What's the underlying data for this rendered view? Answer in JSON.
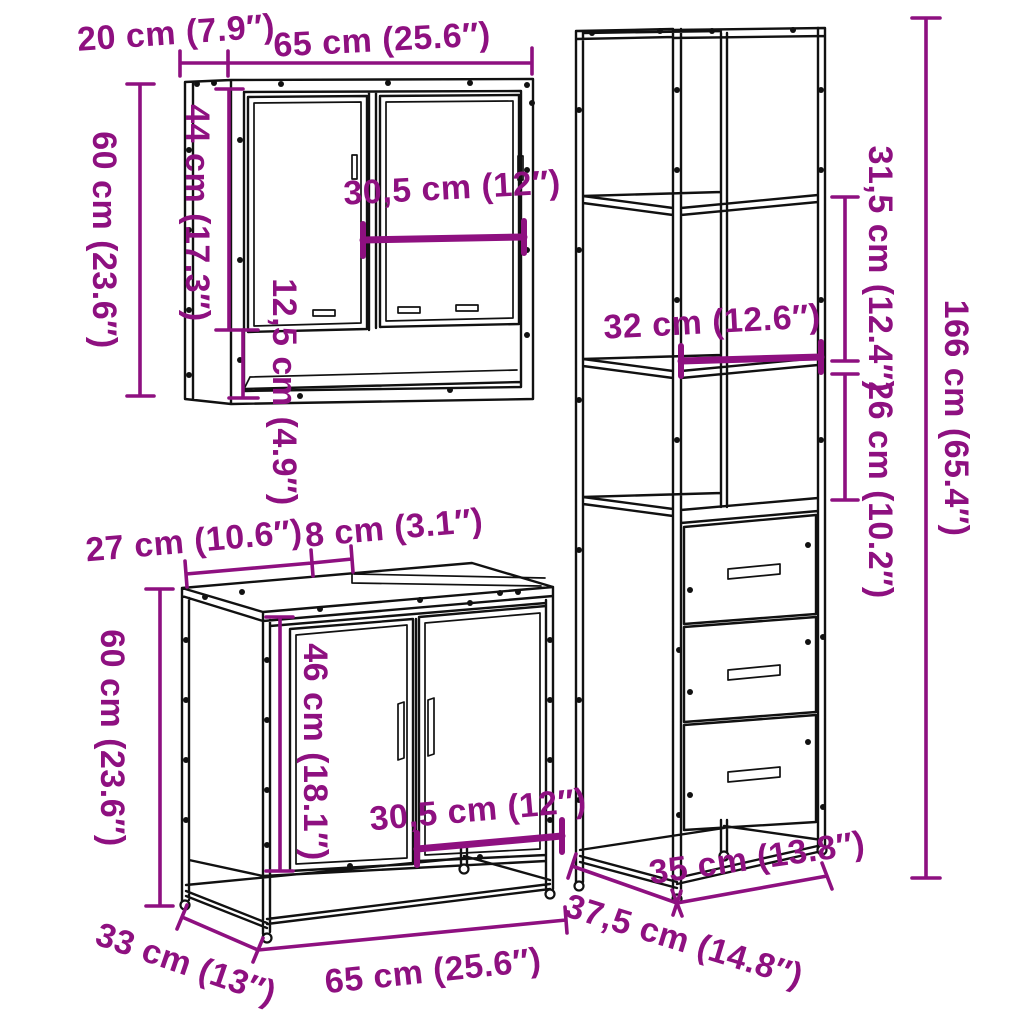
{
  "diagram": {
    "type": "furniture-dimension-diagram",
    "background_color": "#ffffff",
    "line_color": "#111111",
    "accent_color": "#8E1080",
    "pieces": [
      {
        "id": "mirror-cabinet",
        "description": "wall mirror cabinet with two mirror doors and open shelf",
        "dimensions": {
          "depth": "20 cm (7.9″)",
          "width": "65 cm (25.6″)",
          "height": "60 cm (23.6″)",
          "door_height": "44 cm (17.3″)",
          "door_width": "30,5 cm (12″)",
          "open_shelf_height": "12,5 cm (4.9″)"
        }
      },
      {
        "id": "vanity-sink-cabinet",
        "description": "sink vanity cabinet with two doors on metal frame",
        "dimensions": {
          "top_section_depth": "27 cm (10.6″)",
          "top_gap": "8 cm (3.1″)",
          "height": "60 cm (23.6″)",
          "door_height": "46 cm (18.1″)",
          "door_width": "30,5 cm (12″)",
          "depth": "33 cm (13″)",
          "width": "65 cm (25.6″)"
        }
      },
      {
        "id": "tall-cabinet",
        "description": "tall storage cabinet with open shelves and three drawers",
        "dimensions": {
          "upper_section_height": "31,5 cm (12.4″)",
          "shelf_width": "32 cm (12.6″)",
          "middle_section_height": "26 cm (10.2″)",
          "height": "166 cm (65.4″)",
          "width": "35 cm (13.8″)",
          "depth": "37,5 cm (14.8″)"
        }
      }
    ]
  }
}
